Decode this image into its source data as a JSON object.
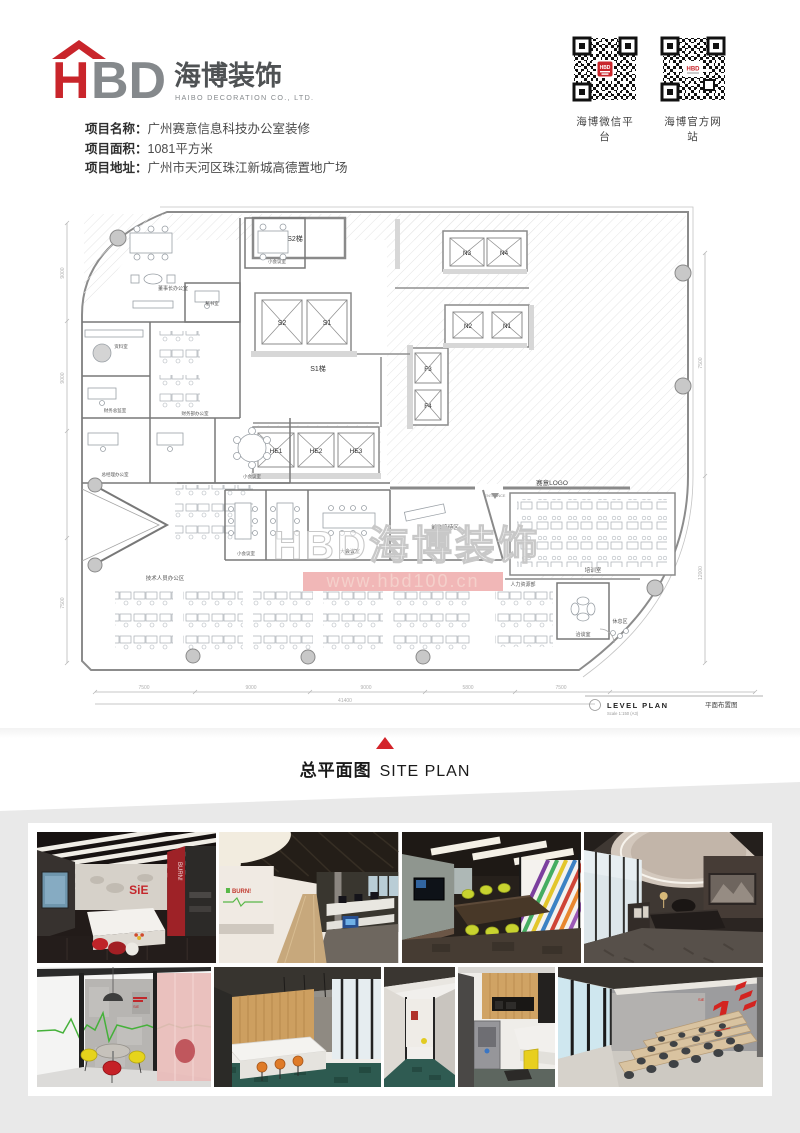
{
  "header": {
    "logo": {
      "h": "H",
      "bd": "BD",
      "cn": "海博装饰",
      "en": "HAIBO DECORATION CO., LTD."
    },
    "qr_left_label": "海博微信平台",
    "qr_right_label": "海博官方网站",
    "qr_center": "HBD"
  },
  "project": {
    "rows": [
      {
        "label": "项目名称：",
        "value": "广州赛意信息科技办公室装修"
      },
      {
        "label": "项目面积：",
        "value": "1081平方米"
      },
      {
        "label": "项目地址：",
        "value": "广州市天河区珠江新城高德置地广场"
      }
    ]
  },
  "plan": {
    "stairs": {
      "s2t": "S2梯",
      "s1t": "S1梯"
    },
    "elev": {
      "s2": "S2",
      "s1": "S1",
      "n3": "N3",
      "n4": "N4",
      "n2": "N2",
      "n1": "N1",
      "f3": "F3",
      "f4": "F4",
      "he1": "HE1",
      "he2": "HE2",
      "he3": "HE3"
    },
    "entrance": "ENTRANCE",
    "logo_label": "赛意LOGO",
    "rooms": {
      "chairman": "董事长办公室",
      "secretary": "秘书室",
      "archive": "资料室",
      "finance_office": "财务部办公室",
      "finance_director": "财务总监室",
      "gm": "总经理办公室",
      "small_meeting": "小会议室",
      "big_meeting": "大会议室",
      "tech": "技术人员办公区",
      "reception": "前台接待区",
      "training": "培训室",
      "hr": "人力资源部",
      "talk": "洽谈室",
      "rest": "休息区"
    },
    "watermark1": "HBD海博装饰",
    "watermark2": "www.hbd100.cn",
    "titleblock": {
      "en": "LEVEL PLAN",
      "scale": "Scale 1:150 (A3)",
      "cn": "平面布置图"
    },
    "dims": {
      "b": [
        "7500",
        "9000",
        "9000",
        "5800",
        "7500"
      ],
      "total": "41400",
      "l": [
        "9000",
        "9000",
        "7500"
      ],
      "r": [
        "7500",
        "12000"
      ]
    }
  },
  "caption": {
    "cn": "总平面图",
    "en": "SITE PLAN"
  },
  "gallery": {
    "texts": {
      "sie": "SiE",
      "burn": "BURN!",
      "one": "1"
    }
  },
  "colors": {
    "accent": "#c9252b",
    "watermark_pink": "#eda5a5",
    "panel_gray": "#e9e9e9",
    "qr_black": "#111111"
  }
}
